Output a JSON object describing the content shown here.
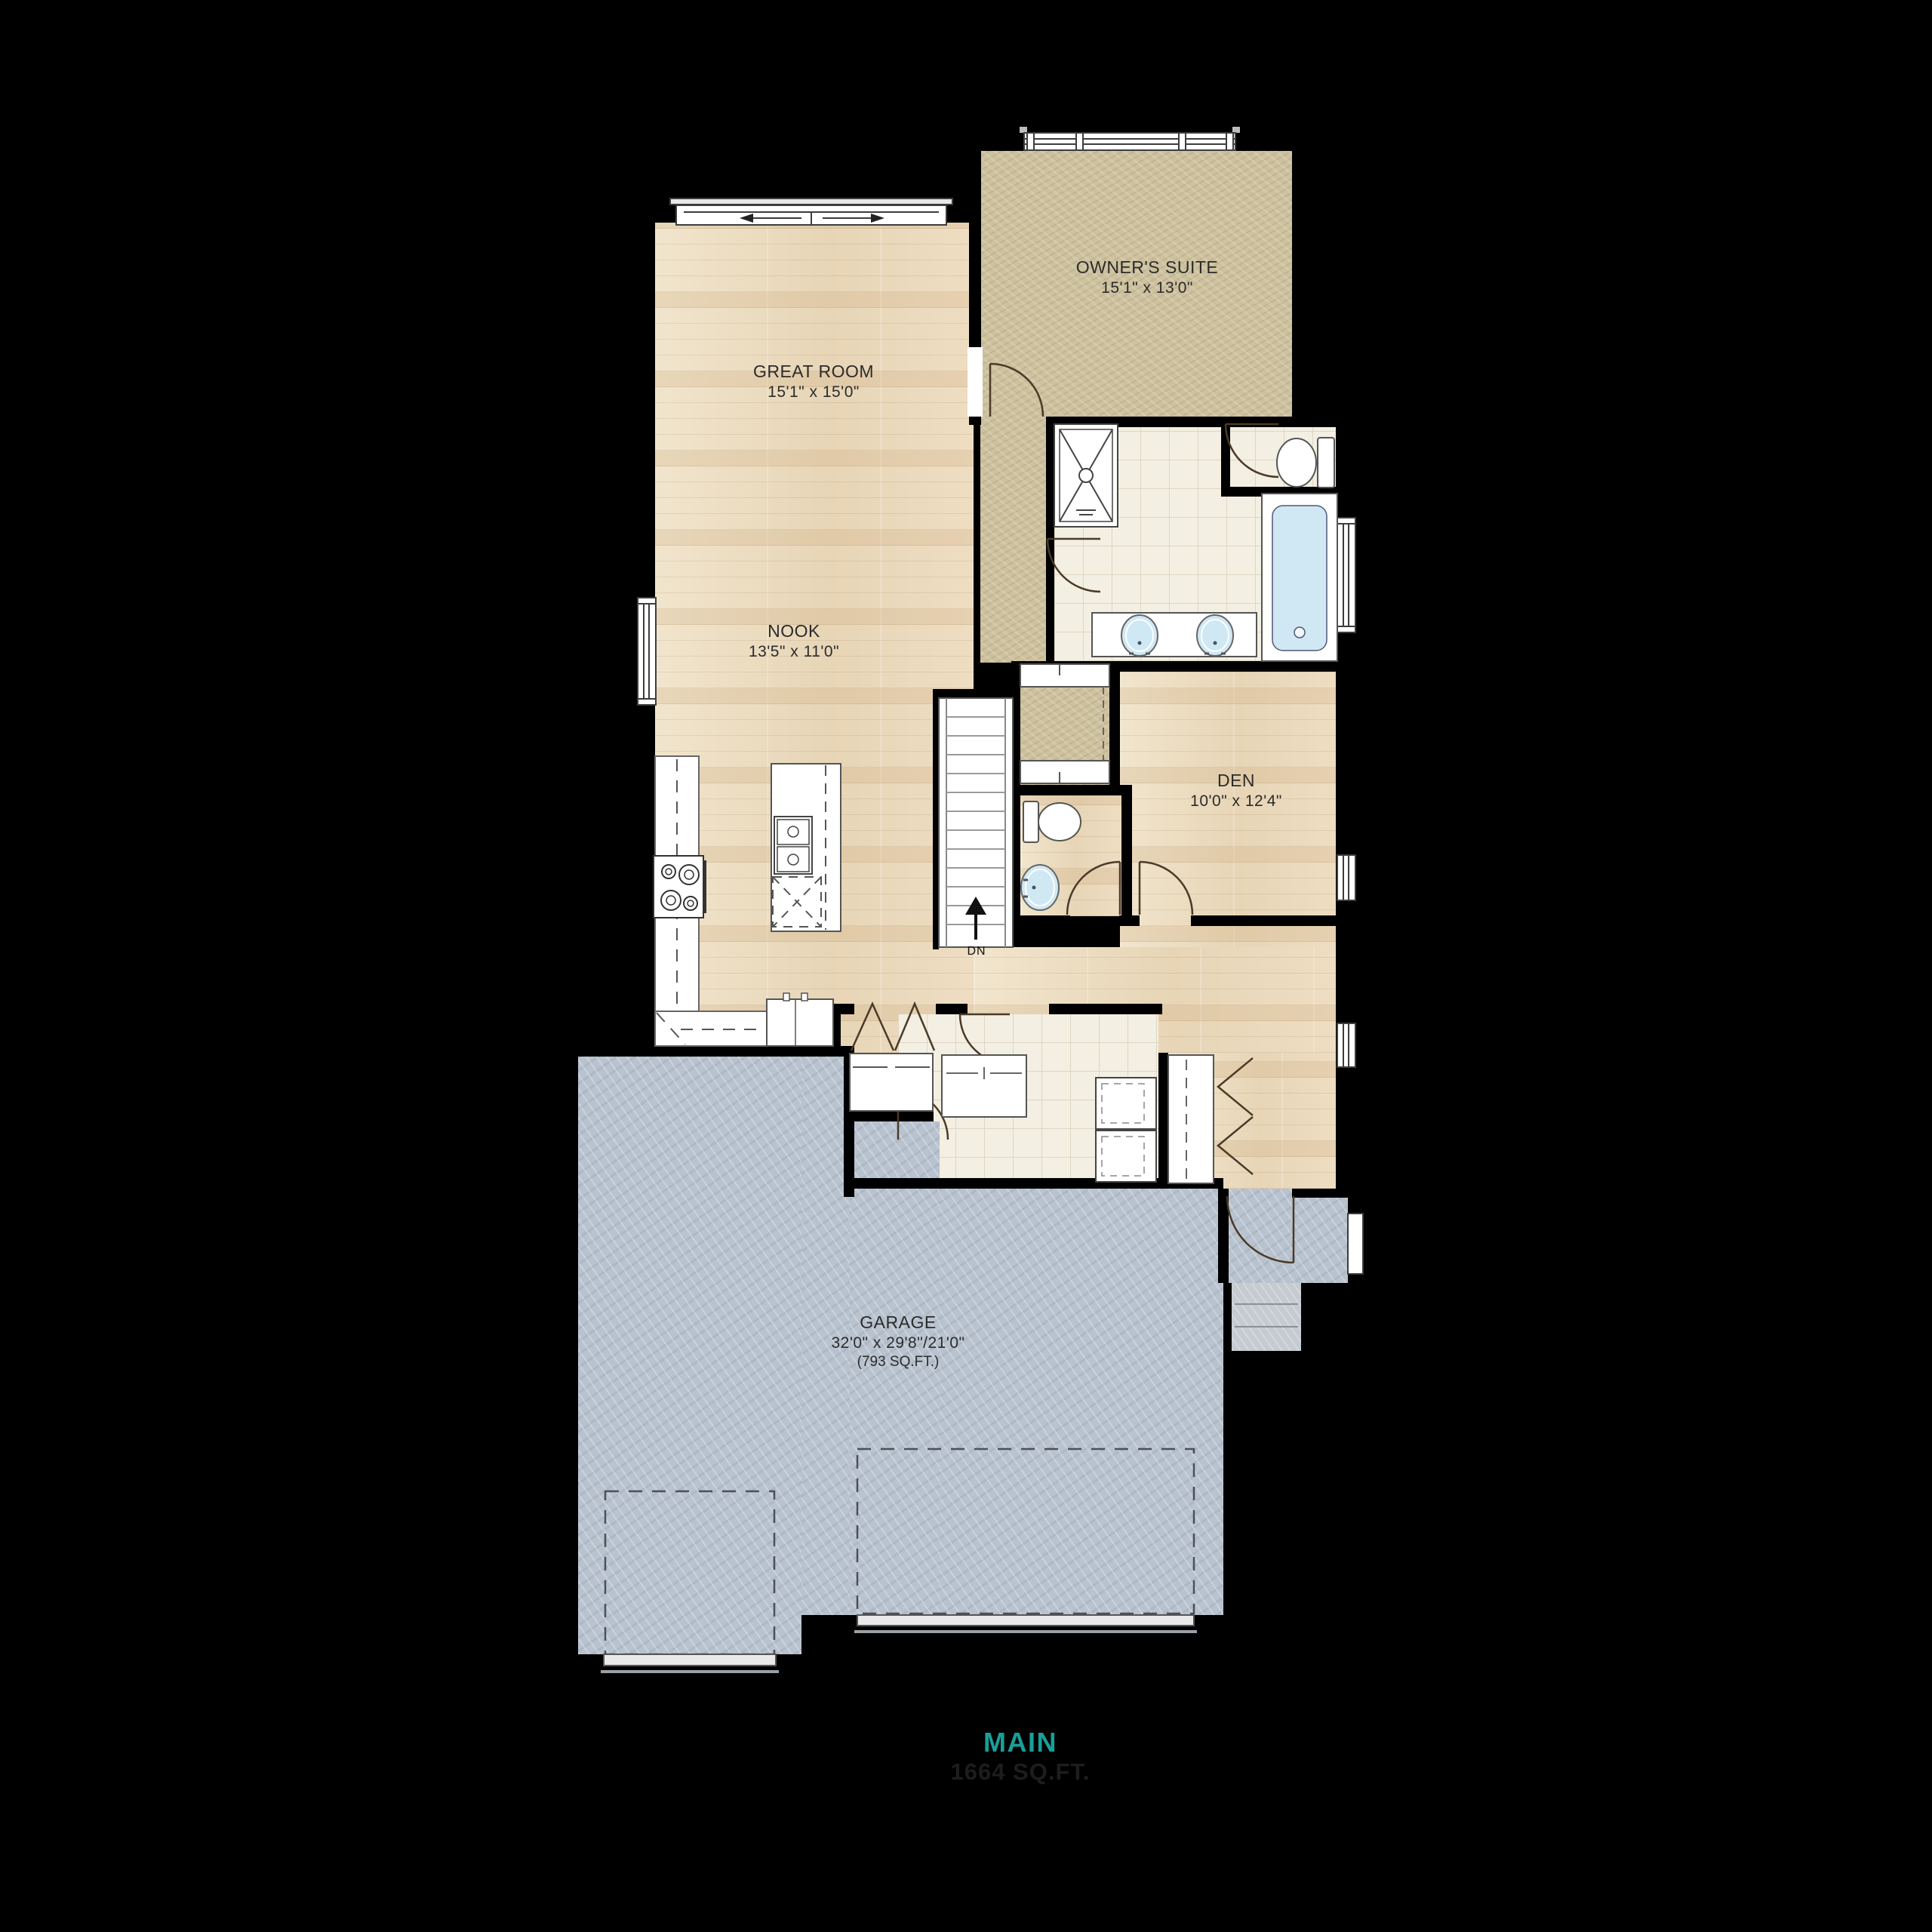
{
  "page": {
    "type": "architectural-floor-plan",
    "floor": "main level"
  },
  "rooms": {
    "owners_suite": {
      "name": "OWNER'S SUITE",
      "dims": "15'1\" x 13'0\""
    },
    "great_room": {
      "name": "GREAT ROOM",
      "dims": "15'1\" x 15'0\""
    },
    "nook": {
      "name": "NOOK",
      "dims": "13'5\" x 11'0\""
    },
    "den": {
      "name": "DEN",
      "dims": "10'0\" x 12'4\""
    },
    "garage": {
      "name": "GARAGE",
      "dims": "32'0\" x 29'8\"/21'0\"",
      "area": "(793 SQ.FT.)"
    }
  },
  "annotations": {
    "stairs_direction": "DN"
  },
  "footer": {
    "floor_label": "MAIN",
    "floor_area": "1664 SQ.FT."
  },
  "colors": {
    "background": "#000000",
    "wood_floor": "#ecdcc2",
    "carpet": "#cdc19e",
    "bath_tile": "#f3efe2",
    "garage_concrete": "#b9c3cf",
    "accent_teal": "#18A099",
    "label_text": "#2b2b2b",
    "water_fixture_blue": "#cfe8f4"
  },
  "fixtures": [
    "sliding-patio-door",
    "bedroom-windows",
    "nook-window",
    "bath-window",
    "den-window",
    "entry-window",
    "shower",
    "water-closet-toilet",
    "bathtub",
    "double-vanity-sinks",
    "powder-toilet",
    "powder-sink",
    "staircase",
    "kitchen-counter",
    "cooktop",
    "refrigerator",
    "island-sink",
    "dishwasher",
    "pantry-double-doors",
    "coat-closet",
    "washer",
    "dryer",
    "bifold-closet-doors",
    "garage-parking-bays",
    "garage-doors",
    "porch",
    "stoop-steps"
  ]
}
